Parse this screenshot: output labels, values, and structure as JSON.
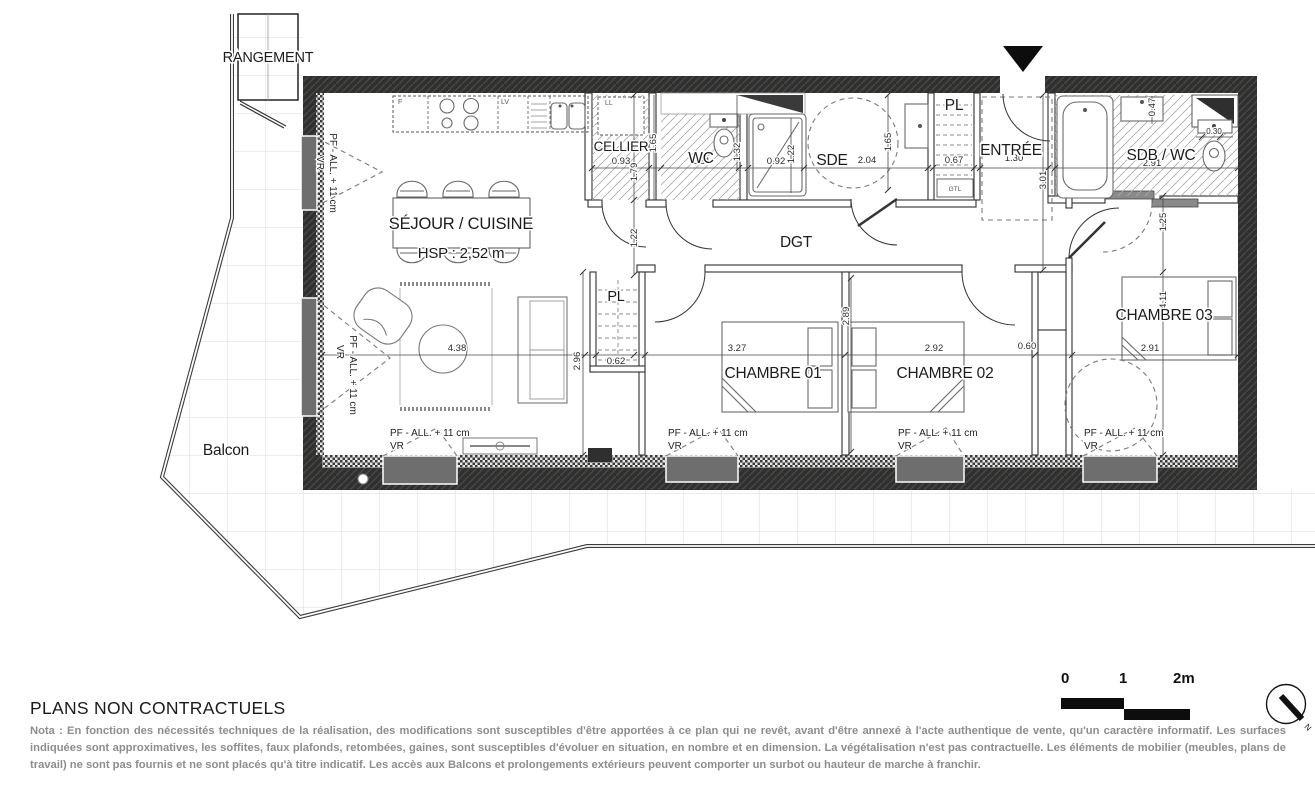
{
  "plan": {
    "rooms": {
      "rangement": "RANGEMENT",
      "sejour": "SÉJOUR / CUISINE",
      "hsp": "HSP : 2,52 m",
      "cellier": "CELLIER",
      "wc": "WC",
      "sde": "SDE",
      "pl_top": "PL",
      "entree": "ENTRÉE",
      "sdb": "SDB / WC",
      "dgt": "DGT",
      "pl_low": "PL",
      "ch1": "CHAMBRE 01",
      "ch2": "CHAMBRE 02",
      "ch3": "CHAMBRE 03",
      "balcon": "Balcon"
    },
    "dims": {
      "kitchen_depth": "1.79",
      "cellier_w": "0.93",
      "cellier_d": "1.65",
      "wc_w": "1.31",
      "wc_d": "1.32",
      "shower_w": "0.92",
      "shower_d": "1.22",
      "sde_w": "2.04",
      "sde_d": "1.65",
      "pl_w": "0.67",
      "entree_w": "1.30",
      "entree_d": "3.01",
      "vanity_d": "0.47",
      "wc2_w": "0.30",
      "sdb_w": "2.91",
      "sdb_d": "1.25",
      "passage": "1.22",
      "sejour_w": "4.38",
      "sejour_d": "2.96",
      "pl2_w": "0.62",
      "ch1_w": "3.27",
      "ch1_d": "2.89",
      "ch2_w": "2.92",
      "gaine_w": "0.60",
      "ch3_w": "2.91",
      "ch3_d": "4.11"
    },
    "fixtures": {
      "f": "F",
      "lv": "LV",
      "ll": "LL",
      "gtl": "GTL"
    },
    "window_label": {
      "line1": "PF - ALL. + 11 cm",
      "line2": "VR"
    }
  },
  "footer": {
    "title": "PLANS NON CONTRACTUELS",
    "nota": "Nota : En fonction des nécessités techniques de la réalisation, des modifications sont susceptibles d'être apportées à ce plan qui ne revêt, avant d'être annexé à l'acte authentique de vente, qu'un caractère informatif. Les surfaces indiquées sont approximatives, les soffites, faux plafonds, retombées, gaines, sont susceptibles d'évoluer en situation, en nombre et en dimension. La végétalisation n'est pas contractuelle. Les éléments de mobilier (meubles, plans de travail) ne sont pas fournis et ne sont placés qu'à titre indicatif. Les accès aux Balcons et prolongements extérieurs peuvent comporter un surbot ou hauteur de marche à franchir."
  },
  "scalebar": {
    "zero": "0",
    "one": "1",
    "two": "2m"
  },
  "north": {
    "n": "N"
  },
  "colors": {
    "wall": "#2f2f2f",
    "dim": "#333333",
    "nota_text": "#8d8d8d"
  }
}
